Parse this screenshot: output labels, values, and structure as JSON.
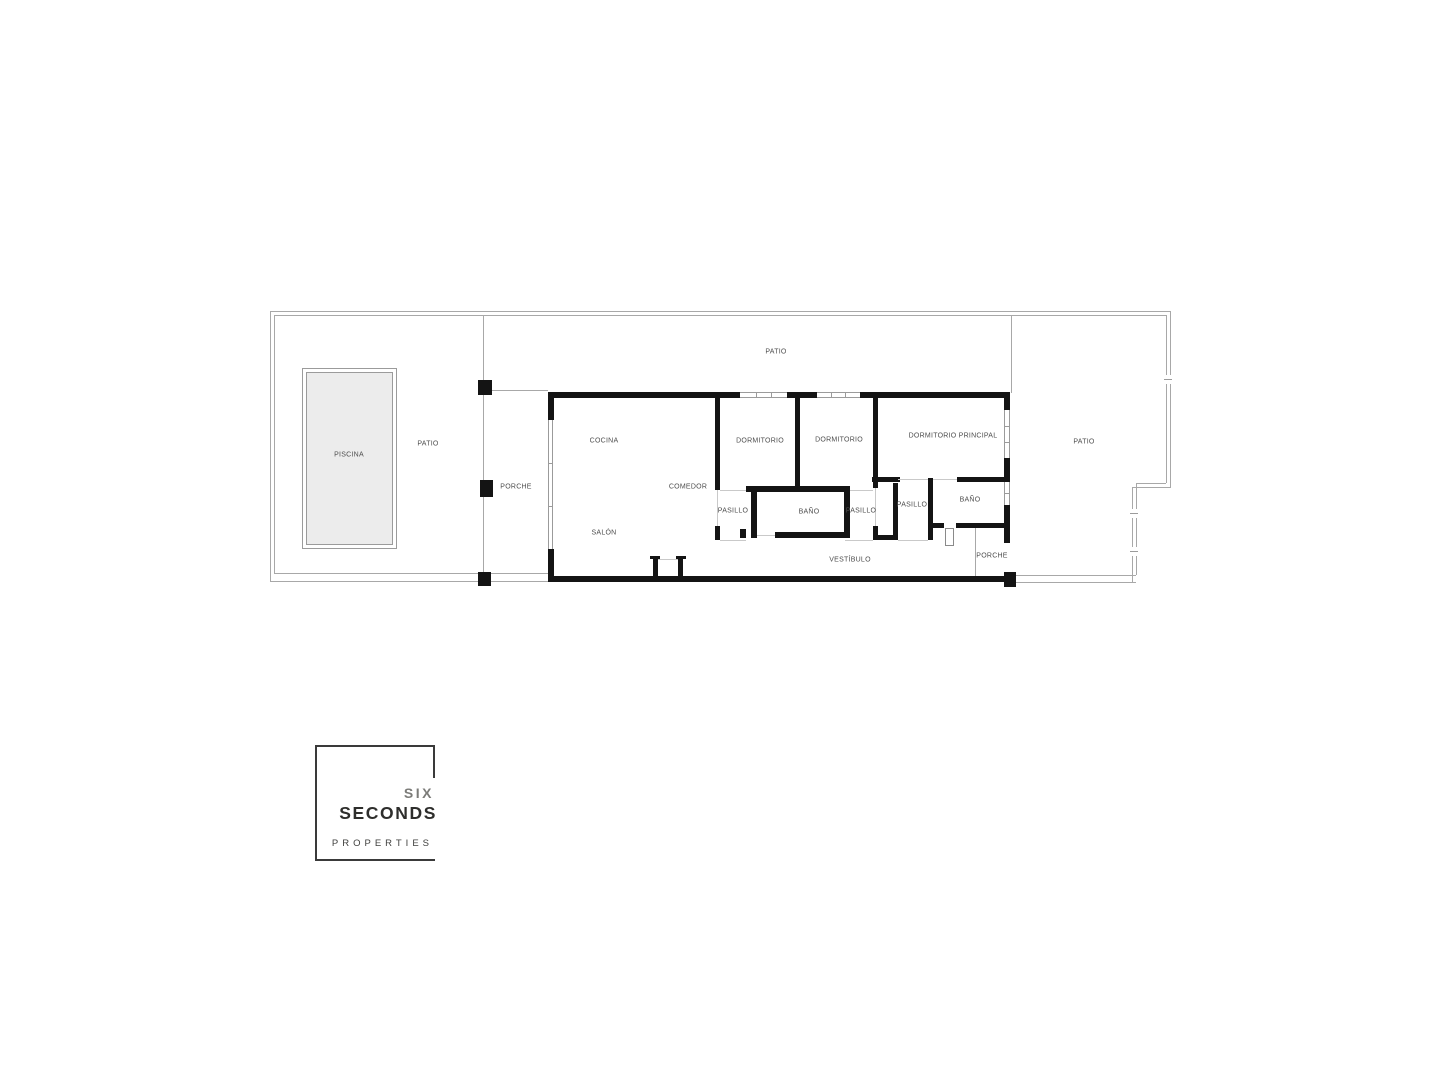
{
  "plan": {
    "labels": {
      "patio_left": "PATIO",
      "piscina": "PISCINA",
      "porche_left": "PORCHE",
      "patio_top": "PATIO",
      "cocina": "COCINA",
      "comedor": "COMEDOR",
      "salon": "SALÓN",
      "dormitorio_1": "DORMITORIO",
      "dormitorio_2": "DORMITORIO",
      "dormitorio_principal": "DORMITORIO PRINCIPAL",
      "pasillo_1": "PASILLO",
      "bano_1": "BAÑO",
      "pasillo_2": "PASILLO",
      "pasillo_3": "PASILLO",
      "bano_2": "BAÑO",
      "vestibulo": "VESTÍBULO",
      "porche_right": "PORCHE",
      "patio_right": "PATIO"
    },
    "colors": {
      "wall": "#141414",
      "boundary_line": "#a8a8a8",
      "pool_fill": "#ececec",
      "label_text": "#4d4d4d"
    }
  },
  "branding": {
    "word_1": "SIX",
    "word_2": "SECONDS",
    "word_3": "PROPERTIES"
  }
}
